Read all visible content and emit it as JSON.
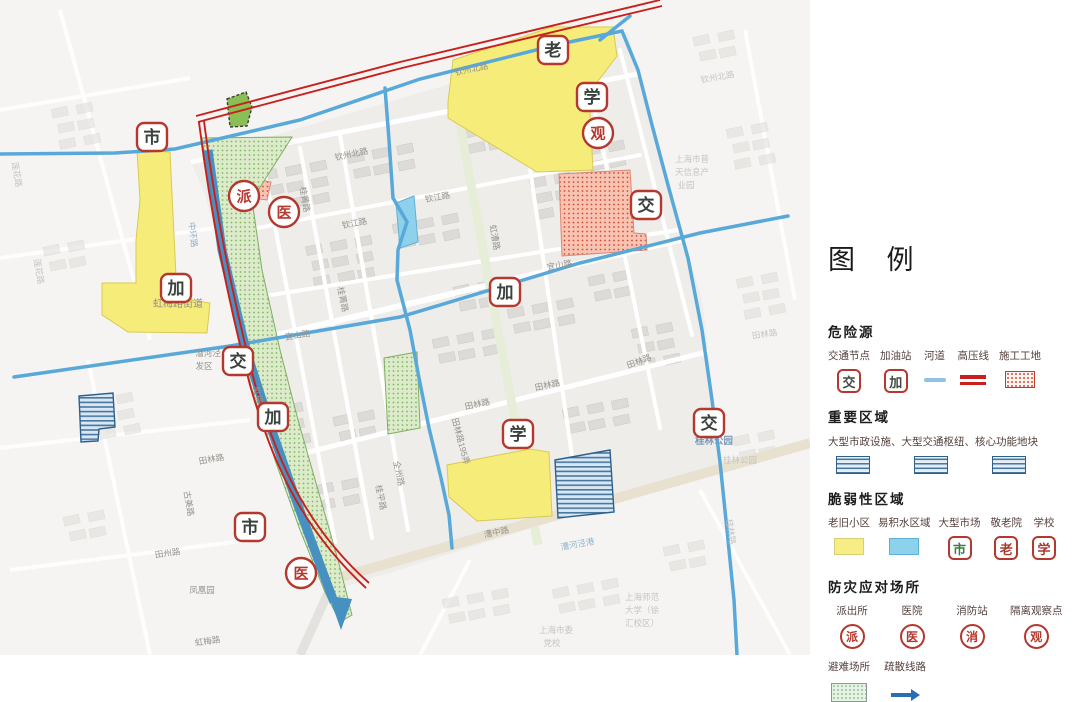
{
  "legend": {
    "title": "图 例",
    "sections": {
      "hazard": {
        "heading": "危险源",
        "items": [
          {
            "label": "交通节点",
            "char": "交",
            "color": "#3f4a42"
          },
          {
            "label": "加油站",
            "char": "加",
            "color": "#3f4a42"
          },
          {
            "label": "河道"
          },
          {
            "label": "高压线"
          },
          {
            "label": "施工工地"
          }
        ]
      },
      "important": {
        "heading": "重要区域",
        "desc": "大型市政设施、大型交通枢纽、核心功能地块"
      },
      "vulnerable": {
        "heading": "脆弱性区域",
        "items": [
          {
            "label": "老旧小区"
          },
          {
            "label": "易积水区域"
          },
          {
            "label": "大型市场",
            "char": "市",
            "color": "#3f7a4a"
          },
          {
            "label": "敬老院",
            "char": "老",
            "color": "#a83a30"
          },
          {
            "label": "学校",
            "char": "学",
            "color": "#a83a30"
          }
        ]
      },
      "response": {
        "heading": "防灾应对场所",
        "items": [
          {
            "label": "派出所",
            "char": "派"
          },
          {
            "label": "医院",
            "char": "医"
          },
          {
            "label": "消防站",
            "char": "消"
          },
          {
            "label": "隔离观察点",
            "char": "观"
          }
        ],
        "items2": [
          {
            "label": "避难场所"
          },
          {
            "label": "疏散线路"
          }
        ]
      }
    }
  },
  "map": {
    "colors": {
      "marker_border": "#b5382e",
      "square_char": "#3a423c",
      "circle_char": "#b5382e",
      "old_residential": "#f6ec7a",
      "flood_area": "#8ed1ec",
      "river": "#58a9da",
      "evacuation": "#4690c2",
      "high_voltage": "#c9201d",
      "shelter_fill": "#dcebc9",
      "construction_fill": "#f9c3b2",
      "important_stripe": "#49779f"
    },
    "markers": [
      {
        "char": "市",
        "shape": "square",
        "x": 152,
        "y": 137
      },
      {
        "char": "派",
        "shape": "circle",
        "x": 244,
        "y": 196
      },
      {
        "char": "医",
        "shape": "circle",
        "x": 284,
        "y": 212
      },
      {
        "char": "加",
        "shape": "square",
        "x": 176,
        "y": 288
      },
      {
        "char": "交",
        "shape": "square",
        "x": 238,
        "y": 361
      },
      {
        "char": "加",
        "shape": "square",
        "x": 273,
        "y": 417
      },
      {
        "char": "市",
        "shape": "square",
        "x": 250,
        "y": 527
      },
      {
        "char": "医",
        "shape": "circle",
        "x": 301,
        "y": 573
      },
      {
        "char": "老",
        "shape": "square",
        "x": 553,
        "y": 50
      },
      {
        "char": "学",
        "shape": "square",
        "x": 592,
        "y": 97
      },
      {
        "char": "观",
        "shape": "circle",
        "x": 598,
        "y": 133
      },
      {
        "char": "交",
        "shape": "square",
        "x": 646,
        "y": 205
      },
      {
        "char": "加",
        "shape": "square",
        "x": 505,
        "y": 292
      },
      {
        "char": "学",
        "shape": "square",
        "x": 518,
        "y": 434
      },
      {
        "char": "交",
        "shape": "square",
        "x": 709,
        "y": 423
      }
    ],
    "labels": [
      {
        "t": "钦州北路",
        "x": 352,
        "y": 157,
        "r": -12,
        "c": "g"
      },
      {
        "t": "钦州北路",
        "x": 472,
        "y": 72,
        "r": -12,
        "c": "g"
      },
      {
        "t": "钦州北路",
        "x": 718,
        "y": 80,
        "r": -10,
        "c": "f"
      },
      {
        "t": "钦江路",
        "x": 355,
        "y": 226,
        "r": -11,
        "c": "g"
      },
      {
        "t": "钦江路",
        "x": 438,
        "y": 200,
        "r": -11,
        "c": "g"
      },
      {
        "t": "桂菁路",
        "x": 302,
        "y": 200,
        "r": 80,
        "c": "g"
      },
      {
        "t": "桂菁路",
        "x": 340,
        "y": 300,
        "r": 78,
        "c": "g"
      },
      {
        "t": "宜山路",
        "x": 298,
        "y": 338,
        "r": -9,
        "c": "g"
      },
      {
        "t": "宜山路",
        "x": 560,
        "y": 268,
        "r": -10,
        "c": "g"
      },
      {
        "t": "田林路",
        "x": 212,
        "y": 462,
        "r": -10,
        "c": "g"
      },
      {
        "t": "田林路",
        "x": 478,
        "y": 407,
        "r": -12,
        "c": "g"
      },
      {
        "t": "田林路",
        "x": 548,
        "y": 388,
        "r": -12,
        "c": "g"
      },
      {
        "t": "田林路",
        "x": 640,
        "y": 364,
        "r": -20,
        "c": "g"
      },
      {
        "t": "田林路",
        "x": 765,
        "y": 337,
        "r": -8,
        "c": "f"
      },
      {
        "t": "田林路195弄",
        "x": 458,
        "y": 442,
        "r": 75,
        "c": "g"
      },
      {
        "t": "田州路",
        "x": 168,
        "y": 556,
        "r": -8,
        "c": "g"
      },
      {
        "t": "古美路",
        "x": 186,
        "y": 504,
        "r": 80,
        "c": "g"
      },
      {
        "t": "凤凰园",
        "x": 202,
        "y": 593,
        "r": 0,
        "c": "g"
      },
      {
        "t": "虹梅路",
        "x": 208,
        "y": 644,
        "r": -8,
        "c": "g"
      },
      {
        "t": "莲花路",
        "x": 14,
        "y": 175,
        "r": 80,
        "c": "f"
      },
      {
        "t": "莲花路",
        "x": 36,
        "y": 272,
        "r": 80,
        "c": "f"
      },
      {
        "t": "中环路",
        "x": 190,
        "y": 235,
        "r": 83,
        "c": "b"
      },
      {
        "t": "虹梅路",
        "x": 256,
        "y": 400,
        "r": 76,
        "c": "g"
      },
      {
        "t": "漕河泾",
        "x": 208,
        "y": 356,
        "r": 0,
        "c": "g"
      },
      {
        "t": "发区",
        "x": 204,
        "y": 369,
        "r": 0,
        "c": "g"
      },
      {
        "t": "虹漕路",
        "x": 492,
        "y": 238,
        "r": 80,
        "c": "g"
      },
      {
        "t": "漕中路",
        "x": 497,
        "y": 535,
        "r": -12,
        "c": "g"
      },
      {
        "t": "漕河泾港",
        "x": 578,
        "y": 547,
        "r": -10,
        "c": "b"
      },
      {
        "t": "桂平路",
        "x": 378,
        "y": 498,
        "r": 78,
        "c": "g"
      },
      {
        "t": "全州路",
        "x": 396,
        "y": 474,
        "r": 78,
        "c": "g"
      },
      {
        "t": "桂林路",
        "x": 728,
        "y": 532,
        "r": 82,
        "c": "f"
      },
      {
        "t": "桂林公园",
        "x": 714,
        "y": 444,
        "r": 0,
        "c": "p"
      },
      {
        "t": "桂林公园",
        "x": 740,
        "y": 463,
        "r": 0,
        "c": "f"
      },
      {
        "t": "虹梅路街道",
        "x": 178,
        "y": 307,
        "r": 0,
        "c": "d"
      },
      {
        "t": "上海市普",
        "x": 692,
        "y": 162,
        "r": 0,
        "c": "f"
      },
      {
        "t": "天信息产",
        "x": 692,
        "y": 175,
        "r": 0,
        "c": "f"
      },
      {
        "t": "业园",
        "x": 686,
        "y": 188,
        "r": 0,
        "c": "f"
      },
      {
        "t": "上海师范",
        "x": 642,
        "y": 600,
        "r": 0,
        "c": "f"
      },
      {
        "t": "大学（徐",
        "x": 642,
        "y": 613,
        "r": 0,
        "c": "f"
      },
      {
        "t": "汇校区）",
        "x": 642,
        "y": 626,
        "r": 0,
        "c": "f"
      },
      {
        "t": "上海市委",
        "x": 556,
        "y": 633,
        "r": 0,
        "c": "f"
      },
      {
        "t": "党校",
        "x": 552,
        "y": 646,
        "r": 0,
        "c": "f"
      }
    ]
  }
}
